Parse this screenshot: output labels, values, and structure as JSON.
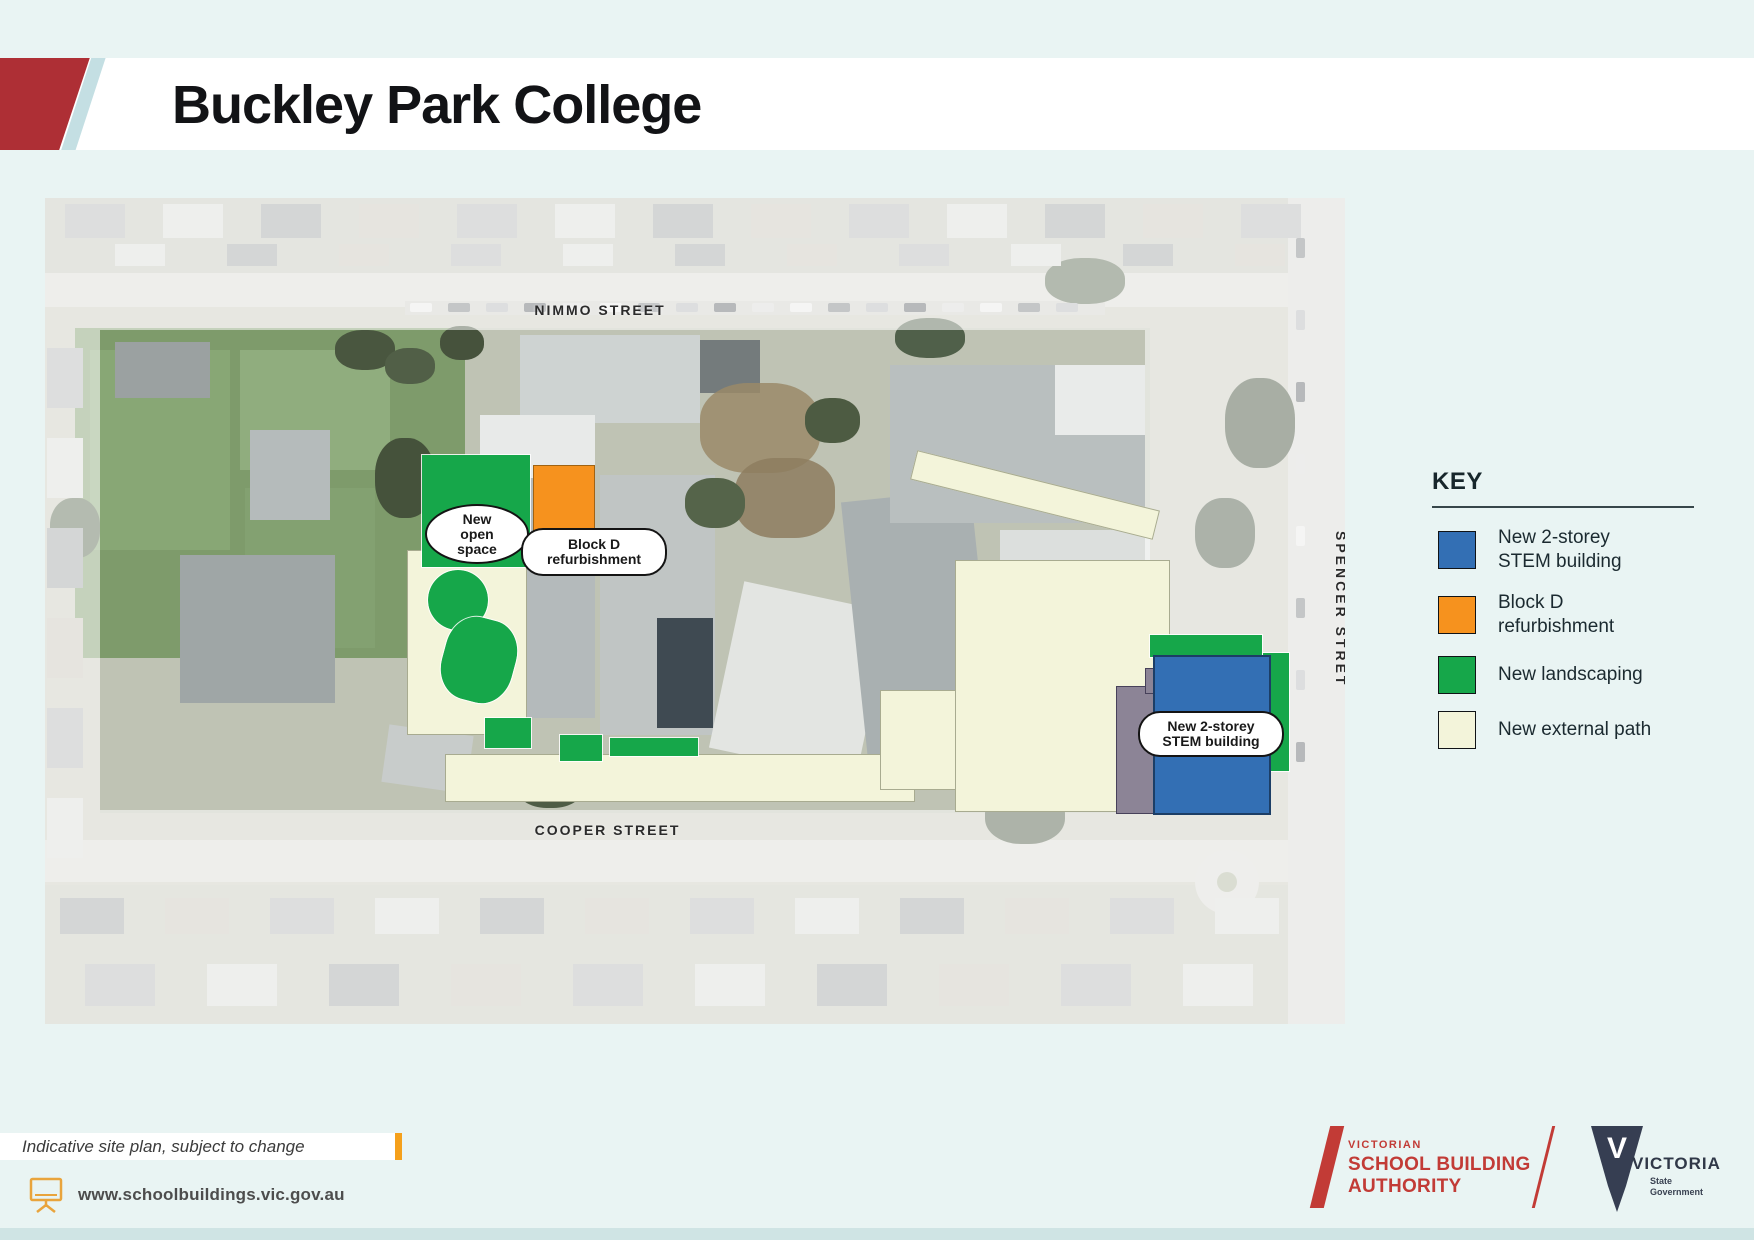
{
  "header": {
    "title": "Buckley Park College"
  },
  "map": {
    "streets": {
      "top": "NIMMO STREET",
      "bottom": "COOPER STREET",
      "right": "SPENCER STRET"
    },
    "annotations": {
      "open_space": {
        "line1": "New",
        "line2": "open",
        "line3": "space"
      },
      "block_d": {
        "line1": "Block D",
        "line2": "refurbishment"
      },
      "stem": {
        "line1": "New 2-storey",
        "line2": "STEM building"
      }
    }
  },
  "legend": {
    "title": "KEY",
    "items": [
      {
        "line1": "New 2-storey",
        "line2": "STEM building",
        "color": "#336fb4"
      },
      {
        "line1": "Block D",
        "line2": "refurbishment",
        "color": "#f6921e"
      },
      {
        "line1": "New landscaping",
        "line2": "",
        "color": "#16a74a"
      },
      {
        "line1": "New external path",
        "line2": "",
        "color": "#f3f4da"
      }
    ]
  },
  "footer": {
    "note": "Indicative site plan, subject to change",
    "url": "www.schoolbuildings.vic.gov.au"
  },
  "logos": {
    "vsba": {
      "tagline": "VICTORIAN",
      "line1": "SCHOOL BUILDING",
      "line2": "AUTHORITY"
    },
    "victoria": {
      "name": "VICTORIA",
      "sub_line1": "State",
      "sub_line2": "Government"
    }
  },
  "colors": {
    "header_red": "#ae2f35",
    "header_blue": "#c4dfe3",
    "accent_orange": "#f5a01b",
    "vsba_red": "#c23b36",
    "victoria_navy": "#363e52"
  }
}
